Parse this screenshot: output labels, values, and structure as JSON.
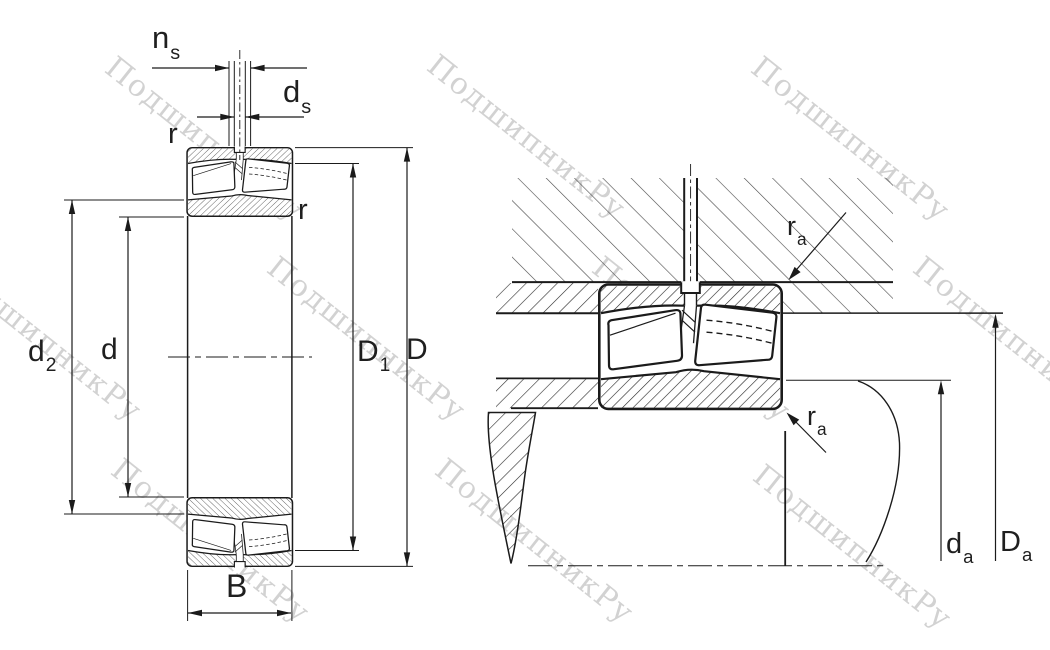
{
  "watermark": {
    "text": "ПодшипникРу"
  },
  "left_figure": {
    "description": "spherical roller bearing cross-section with boundary dimensions",
    "labels": {
      "ns": {
        "main": "n",
        "sub": "s"
      },
      "ds": {
        "main": "d",
        "sub": "s"
      },
      "r_outer": {
        "main": "r"
      },
      "r_inner": {
        "main": "r"
      },
      "d2": {
        "main": "d",
        "sub": "2"
      },
      "d": {
        "main": "d"
      },
      "D1": {
        "main": "D",
        "sub": "1"
      },
      "D": {
        "main": "D"
      },
      "B": {
        "main": "B"
      }
    }
  },
  "right_figure": {
    "description": "bearing mounted in housing and on shaft with abutment dimensions",
    "labels": {
      "ra_housing": {
        "main": "r",
        "sub": "a"
      },
      "ra_shaft": {
        "main": "r",
        "sub": "a"
      },
      "da": {
        "main": "d",
        "sub": "a"
      },
      "Da": {
        "main": "D",
        "sub": "a"
      }
    }
  },
  "colors": {
    "line": "#1b1b1b",
    "housing_hatch": "#474747",
    "label_text": "#1f1f1f",
    "watermark": "#737373"
  }
}
